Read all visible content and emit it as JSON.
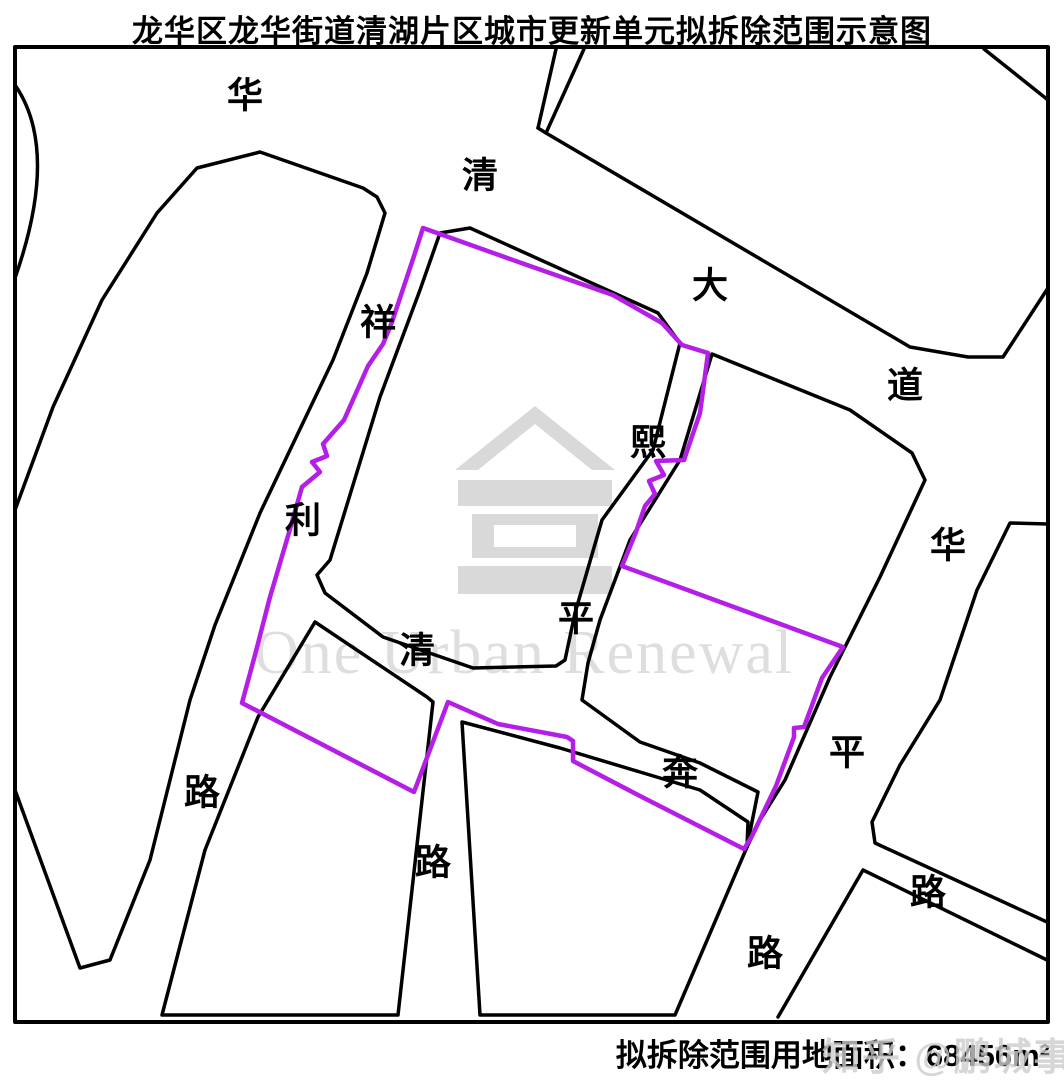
{
  "title": "龙华区龙华街道清湖片区城市更新单元拟拆除范围示意图",
  "caption": {
    "area_label": "拟拆除范围用地面积：",
    "area_value": "68456m²"
  },
  "watermarks": {
    "center_text": "One Urban Renewal",
    "corner_text": "知乎 @鹏城事记",
    "logo": "house-pavilion-icon",
    "logo_color": "#d9d9d9",
    "text_color": "#dedede"
  },
  "colors": {
    "road_outline": "#000000",
    "demolition_boundary": "#b41ee6",
    "background": "#ffffff"
  },
  "map": {
    "boundary_name": "proposed-demolition-boundary",
    "boundary_path": "M423,228 L527,265 L613,295 L662,323 L682,345 L708,353 L700,413 L684,460 L656,461 L664,475 L649,481 L655,494 L645,506 L636,532 L622,566 L843,647 L822,678 L804,727 L794,728 L794,737 L776,786 L752,836 L744,849 L640,796 L573,761 L573,741 L567,737 L498,724 L448,702 L414,792 L242,703 L255,655 L270,597 L288,536 L302,487 L320,472 L312,462 L327,456 L323,444 L344,420 L368,366 L383,344 L392,322 L414,256 Z",
    "roads": [
      {
        "name": "map-border",
        "path": "M15,47 L1048,47 L1048,1022 L15,1022 Z",
        "width": 4
      },
      {
        "name": "corner-arc-northwest",
        "path": "M15,85 Q60,150 15,278",
        "width": 3.5
      },
      {
        "name": "top-road-west-edge",
        "path": "M556,49 L538,128",
        "width": 3.5
      },
      {
        "name": "top-road-east-edge",
        "path": "M584,49 L546,133",
        "width": 3.5
      },
      {
        "name": "huaqing-avenue-north-edge",
        "path": "M538,128 L546,133 L910,347 L968,357 L1003,357 L1048,288",
        "width": 3.5
      },
      {
        "name": "northeast-corner-cut",
        "path": "M984,49 L1048,100",
        "width": 3.5
      },
      {
        "name": "west-block-outline",
        "path": "M197,168 L260,152 L363,188 L377,197 L385,213 L367,273 L333,360 L290,450 L260,513 L215,625 L190,700 L150,860 L110,960 L80,968 L15,790 L15,510 L53,407 L102,300 L157,213 Z",
        "width": 3.5
      },
      {
        "name": "central-block-outline",
        "path": "M440,233 L470,228 L658,313 L680,343 L653,450 L602,520 L575,613 L565,660 L556,666 L473,668 L383,637 L325,593 L317,575 L330,560 L380,397 L420,290 Z",
        "width": 3.5
      },
      {
        "name": "east-block-outline",
        "path": "M712,354 L850,410 L912,453 L925,480 L880,577 L830,677 L785,780 L760,820 L747,847 L758,792 L700,763 L640,742 L582,700 L588,663 L600,620 L630,540 L680,460 Z",
        "width": 3.5
      },
      {
        "name": "southwest-block-outline",
        "path": "M315,622 L427,697 L433,702 L398,1015 L162,1015 L205,850 L258,717 Z",
        "width": 3.5
      },
      {
        "name": "south-block-outline",
        "path": "M462,722 L560,748 L640,772 L700,790 L748,822 L747,847 L675,1015 L480,1015 Z",
        "width": 3.5
      },
      {
        "name": "huaping-road-east-edge",
        "path": "M1048,524 L1010,523 L977,590 L940,700 L900,765 L872,822 L875,843 L1047,922",
        "width": 3.5
      },
      {
        "name": "southeast-road-south-edge",
        "path": "M778,1017 L863,870 L1047,960",
        "width": 3.5
      }
    ],
    "labels": [
      {
        "char": "华",
        "x": 245,
        "y": 95,
        "road": "华清大道"
      },
      {
        "char": "清",
        "x": 480,
        "y": 175,
        "road": "华清大道"
      },
      {
        "char": "大",
        "x": 710,
        "y": 285,
        "road": "华清大道"
      },
      {
        "char": "道",
        "x": 905,
        "y": 385,
        "road": "华清大道"
      },
      {
        "char": "祥",
        "x": 378,
        "y": 322,
        "road": "祥利路"
      },
      {
        "char": "利",
        "x": 303,
        "y": 520,
        "road": "祥利路"
      },
      {
        "char": "路",
        "x": 202,
        "y": 792,
        "road": "祥利路"
      },
      {
        "char": "清",
        "x": 417,
        "y": 650,
        "road": "清平路"
      },
      {
        "char": "路",
        "x": 433,
        "y": 862,
        "road": "清平路"
      },
      {
        "char": "熙",
        "x": 648,
        "y": 442,
        "road": "熙平路"
      },
      {
        "char": "平",
        "x": 576,
        "y": 618,
        "road": "熙平路"
      },
      {
        "char": "路",
        "x": 765,
        "y": 953,
        "road": "熙平路"
      },
      {
        "char": "奔",
        "x": 680,
        "y": 772,
        "road": "奔路"
      },
      {
        "char": "华",
        "x": 948,
        "y": 545,
        "road": "华平路"
      },
      {
        "char": "平",
        "x": 847,
        "y": 752,
        "road": "华平路"
      },
      {
        "char": "路",
        "x": 928,
        "y": 892,
        "road": "华平路"
      }
    ],
    "label_font_size": 36
  }
}
